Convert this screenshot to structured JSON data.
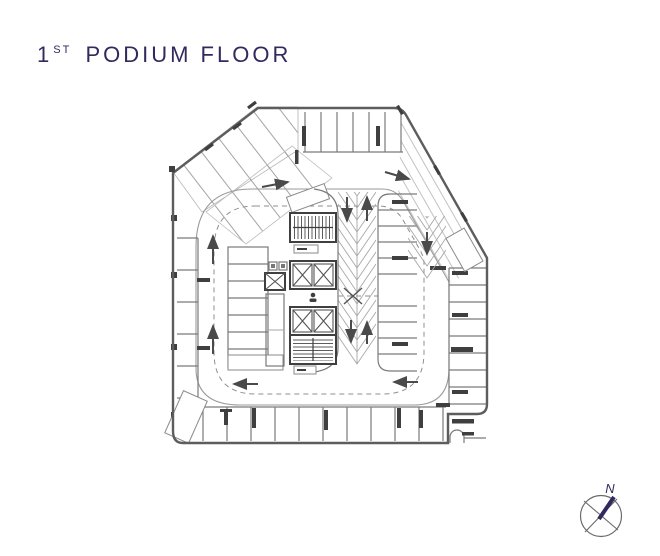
{
  "title": {
    "number": "1",
    "ordinal": "ST",
    "name": "PODIUM FLOOR"
  },
  "colors": {
    "accent": "#32295e",
    "wall": "#5d5d5d",
    "line": "#7a7a7a",
    "thin_line": "#a6a6a6",
    "dark_marks": "#3f3f3f",
    "background": "#ffffff"
  },
  "plan": {
    "kind": "parking-garage-floor-plan",
    "features": [
      "perimeter parking stalls on all four sides",
      "angled parking stalls along the cut north-west corner",
      "central core with two stairwells and four elevator shafts",
      "two-lane centre ramp with chevron road markings",
      "one-way drive aisle ring with dashed centreline and direction arrows"
    ]
  },
  "compass": {
    "label": "N"
  }
}
